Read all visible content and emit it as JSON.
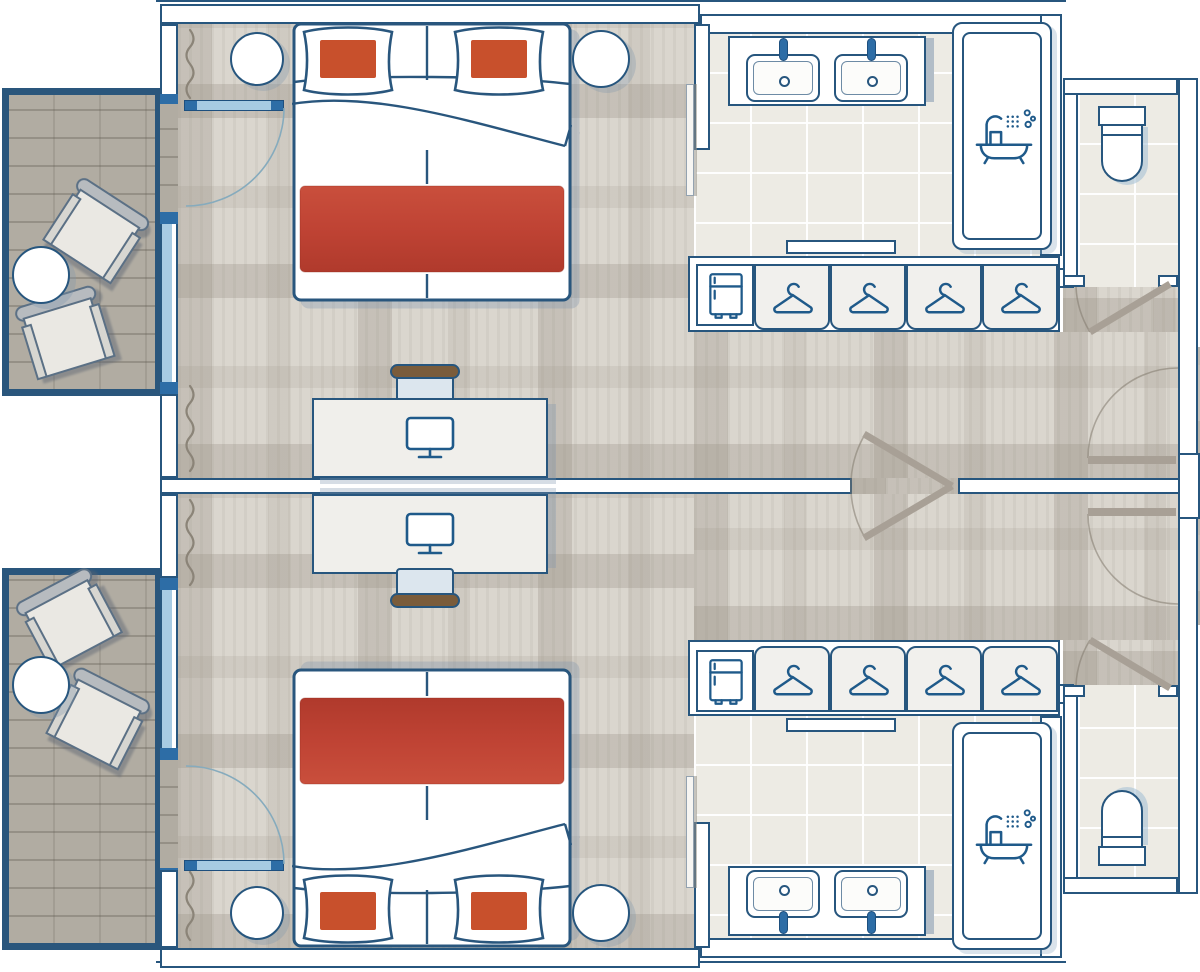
{
  "meta": {
    "type": "hotel-guestroom-floor-plan",
    "description": "Two mirrored hotel guestrooms sharing a central party wall with connecting doors; balconies on the left, bathrooms and separate WCs on the right, entry doors from corridor at right"
  },
  "palette": {
    "wall_line": "#27567e",
    "wall_fill": "#ffffff",
    "glass": "#a7cbe3",
    "door_cap": "#2d6da6",
    "carpet": "#dad6ce",
    "wood": "#b1aca2",
    "tile": "#edebe4",
    "blanket_red": "#bf4334",
    "pillow_red": "#c8502c",
    "furniture": "#f0efeb",
    "door_leaf": "#a8a096",
    "chair_brown": "#7a5c3b"
  },
  "icons": [
    "hanger-icon",
    "minibar-fridge-icon",
    "monitor-icon",
    "bath-shower-icon"
  ],
  "rooms": {
    "guestroom_top": {
      "furniture": [
        "double-bed",
        "pillow",
        "pillow",
        "nightstand",
        "nightstand",
        "desk",
        "desk-chair",
        "monitor",
        "wardrobe-with-hangers",
        "minibar-fridge"
      ],
      "bathroom": [
        "double-vanity",
        "sink",
        "sink",
        "bathtub-shower"
      ],
      "wc": [
        "toilet"
      ],
      "openings": [
        "balcony-door",
        "window",
        "entry-door",
        "connecting-door",
        "wc-door"
      ]
    },
    "guestroom_bottom": {
      "furniture": [
        "double-bed",
        "pillow",
        "pillow",
        "nightstand",
        "nightstand",
        "desk",
        "desk-chair",
        "monitor",
        "wardrobe-with-hangers",
        "minibar-fridge"
      ],
      "bathroom": [
        "double-vanity",
        "sink",
        "sink",
        "bathtub-shower"
      ],
      "wc": [
        "toilet"
      ],
      "openings": [
        "balcony-door",
        "window",
        "entry-door",
        "connecting-door",
        "wc-door"
      ]
    },
    "balcony_top": {
      "items": [
        "armchair",
        "armchair",
        "round-table"
      ]
    },
    "balcony_bottom": {
      "items": [
        "armchair",
        "armchair",
        "round-table"
      ]
    }
  },
  "counts": {
    "beds": 2,
    "pillows": 4,
    "hangers": 8,
    "sinks": 4,
    "toilets": 2,
    "bathtubs": 2,
    "desks": 2,
    "monitors": 2,
    "fridges": 2,
    "armchairs": 4,
    "nightstands": 4,
    "curtains": 4
  }
}
